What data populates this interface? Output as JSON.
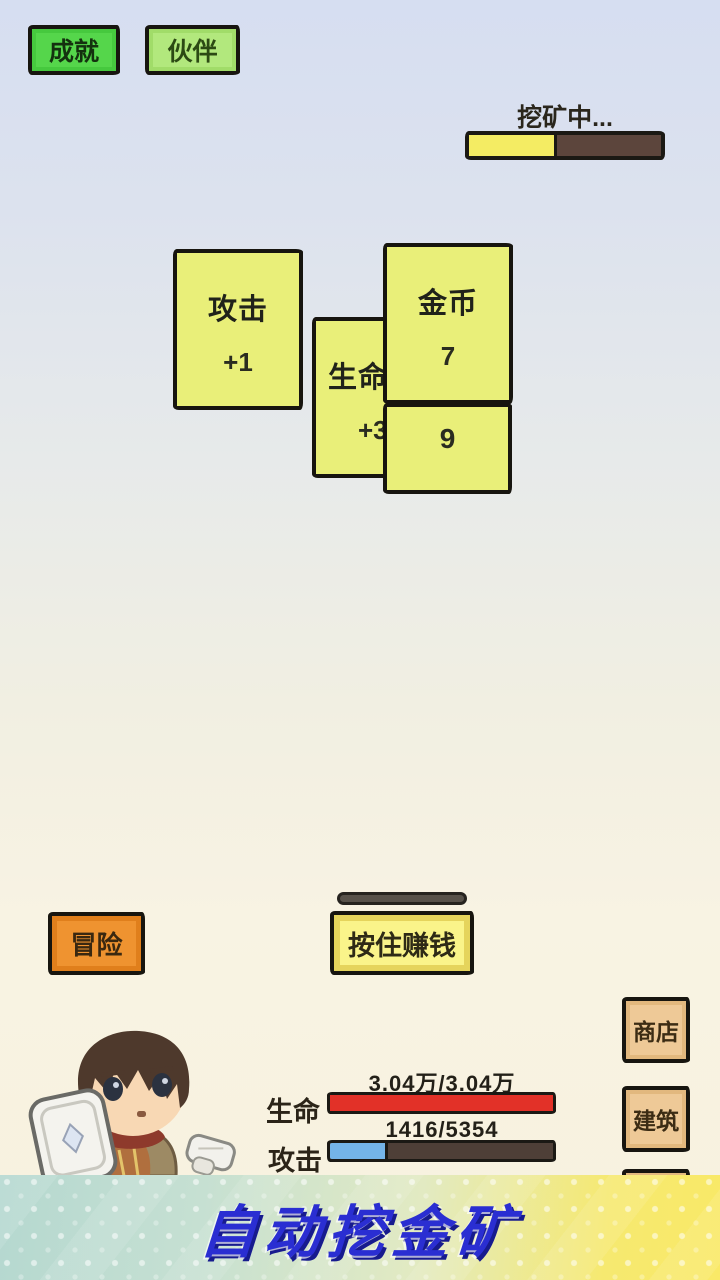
{
  "top_bar": {
    "achievements": "成就",
    "partners": "伙伴"
  },
  "mining": {
    "status": "挖矿中...",
    "progress_percent": 46
  },
  "cards": {
    "attack": {
      "title": "攻击",
      "value": "+1"
    },
    "life": {
      "title": "生命",
      "value": "+3"
    },
    "gold": {
      "title": "金币",
      "value": "7"
    },
    "gold_partial": {
      "value": "9"
    }
  },
  "actions": {
    "adventure": "冒险",
    "hold_to_earn": "按住赚钱"
  },
  "side_menu": {
    "shop": "商店",
    "build": "建筑"
  },
  "stats": {
    "hp_label": "生命",
    "hp_value": "3.04万/3.04万",
    "hp_percent": 100,
    "atk_label": "攻击",
    "atk_value": "1416/5354",
    "atk_percent": 26
  },
  "banner": {
    "title": "自动挖金矿"
  },
  "colors": {
    "achievement_green": "#55d64b",
    "partner_green": "#b2e87d",
    "card_yellow": "#e9ef79",
    "adventure_orange": "#ef9330",
    "hold_yellow": "#faf48a",
    "side_tan": "#eec997",
    "hp_red": "#e23128",
    "atk_blue": "#74b4e8",
    "mine_fill_yellow": "#f4ec63",
    "mine_bg_brown": "#5c453c",
    "banner_text_blue": "#2a2ed2"
  }
}
